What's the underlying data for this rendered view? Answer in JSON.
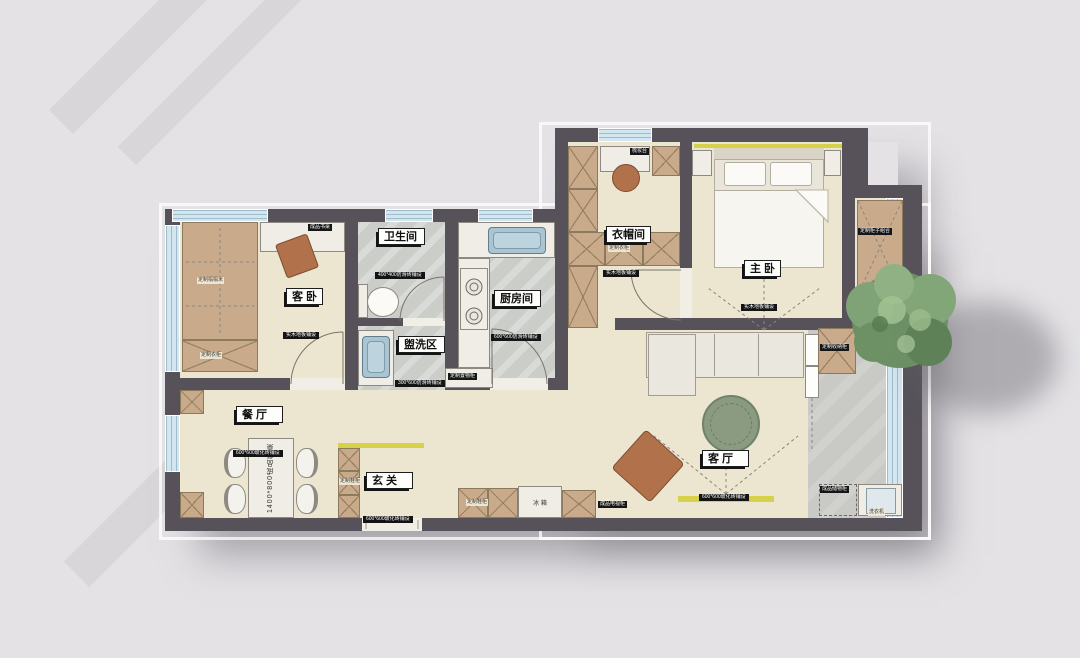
{
  "scene": {
    "type": "residential-floor-plan",
    "style": "top-down color rendering"
  },
  "rooms": {
    "guest_bedroom": {
      "label": "客 卧",
      "spec": "实木地板铺设"
    },
    "bathroom": {
      "label": "卫生间",
      "spec": "400*400防滑砖铺设"
    },
    "washing_area": {
      "label": "盥洗区",
      "spec": "300*600防滑砖铺设"
    },
    "kitchen": {
      "label": "厨房间",
      "spec": "600*600防滑砖铺设"
    },
    "cloakroom": {
      "label": "衣帽间",
      "spec": "实木地板铺设"
    },
    "master_bedroom": {
      "label": "主 卧",
      "spec": "实木地板铺设"
    },
    "dining_room": {
      "label": "餐 厅",
      "spec": "600*600玻化砖铺设"
    },
    "entry": {
      "label": "玄 关",
      "spec": "600*600玻化砖铺设"
    },
    "living_room": {
      "label": "客 厅",
      "spec": "600*600玻化砖铺设"
    }
  },
  "furniture": {
    "tatami": "定制榻榻米",
    "tatami_wardrobe": "定制衣柜",
    "desk": "成品书桌",
    "wardrobe": "定制衣柜",
    "dresser": "梳妆台",
    "bay_cabinet": "定制柜子组合",
    "dining_table": "1400*800成品餐桌",
    "shoe_column": "定制鞋柜",
    "shoe_cabinet": "定制鞋柜",
    "fridge": "冰 箱",
    "tv_cabinet": "成品电视柜",
    "storage_cabinet": "定制置物柜",
    "washer": "洗衣机",
    "balcony_storage": "成品储物柜",
    "balcony_cabinet": "定制收纳柜"
  },
  "colors": {
    "background": "#e4e2e5",
    "wall": "#57525a",
    "floor_wood": "#ece5cf",
    "floor_tile": "#cbcdc9",
    "cabinet": "#c9aa8b",
    "window": "#d3e6ef",
    "accent_yellow": "#d6d04b",
    "rug_green": "#8b9b82",
    "chair_brown": "#b0714b"
  }
}
